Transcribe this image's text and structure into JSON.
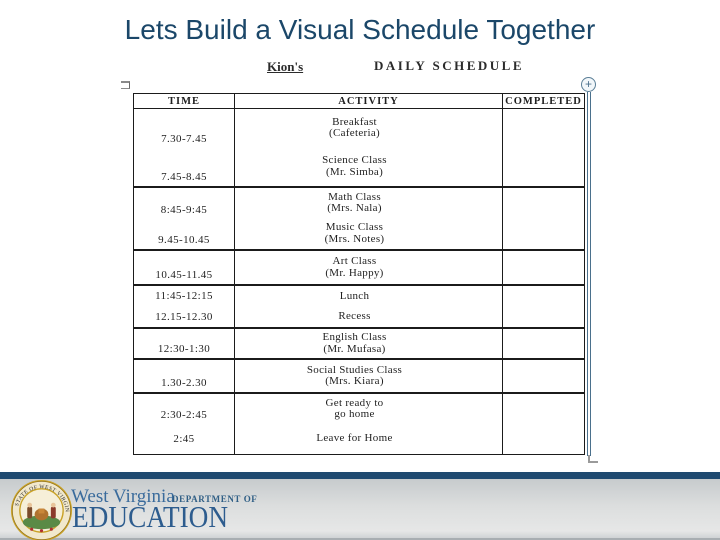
{
  "slide": {
    "title": "Lets Build a Visual Schedule Together"
  },
  "document": {
    "owner_name": "Kion's",
    "header_title": "DAILY SCHEDULE",
    "table": {
      "columns": [
        "TIME",
        "ACTIVITY",
        "COMPLETED"
      ],
      "groups": [
        {
          "height": 77,
          "entries": [
            {
              "time": "7.30-7.45",
              "activity": [
                "Breakfast",
                "(Cafeteria)"
              ]
            },
            {
              "time": "7.45-8.45",
              "activity": [
                "Science Class",
                "(Mr. Simba)"
              ]
            }
          ]
        },
        {
          "height": 63,
          "entries": [
            {
              "time": "8:45-9:45",
              "activity": [
                "Math Class",
                "(Mrs. Nala)"
              ]
            },
            {
              "time": "9.45-10.45",
              "activity": [
                "Music Class",
                "(Mrs. Notes)"
              ]
            }
          ]
        },
        {
          "height": 35,
          "entries": [
            {
              "time": "10.45-11.45",
              "activity": [
                "Art Class",
                "(Mr. Happy)"
              ]
            }
          ]
        },
        {
          "height": 43,
          "entries": [
            {
              "time": "11:45-12:15",
              "activity": [
                "Lunch"
              ]
            },
            {
              "time": "12.15-12.30",
              "activity": [
                "Recess"
              ]
            }
          ]
        },
        {
          "height": 31,
          "entries": [
            {
              "time": "12:30-1:30",
              "activity": [
                "English Class",
                "(Mr. Mufasa)"
              ]
            }
          ]
        },
        {
          "height": 34,
          "entries": [
            {
              "time": "1.30-2.30",
              "activity": [
                "Social Studies Class",
                "(Mrs. Kiara)"
              ]
            }
          ]
        },
        {
          "height": 62,
          "entries": [
            {
              "time": "2:30-2:45",
              "activity": [
                "Get ready to",
                "go home"
              ]
            },
            {
              "time": "2:45",
              "activity": [
                "Leave for Home"
              ]
            }
          ]
        }
      ]
    },
    "controls": {
      "plus_icon": "+"
    }
  },
  "footer": {
    "org_name": "West Virginia",
    "org_dept": "DEPARTMENT OF",
    "org_word": "EDUCATION",
    "seal_text": "STATE OF WEST VIRGINIA"
  },
  "colors": {
    "title_blue": "#1b4769",
    "footer_navy": "#1f4a70",
    "footer_gray": "#dcdede",
    "org_blue": "#2d5c8e",
    "seal_gold": "#d4a937",
    "table_line": "#1b1b1b",
    "doc_edge_blue": "#4a708c"
  }
}
